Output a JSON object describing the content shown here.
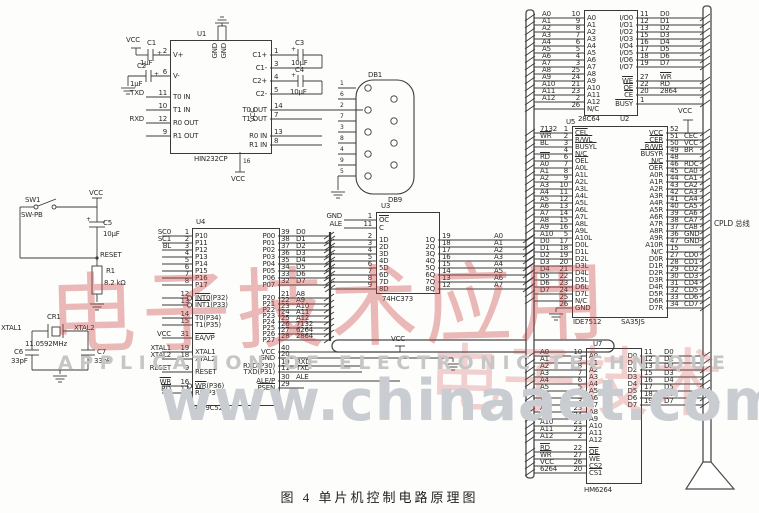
{
  "figure": {
    "caption": "图 4  单片机控制电路原理图"
  },
  "watermark": {
    "tagline": "APPLICATION OF ELECTRONIC TECHNIQUE",
    "url": "www.chinaaet.com",
    "stamp1": "电子技术应用",
    "stamp2": "电子技术"
  },
  "connector": {
    "ref": "DB1",
    "type": "DB9",
    "pins": [
      "1",
      "6",
      "2",
      "7",
      "3",
      "8",
      "4",
      "9",
      "5"
    ]
  },
  "annotations": {
    "vcc_c1": "VCC",
    "c1": "C1",
    "c1v": "1μF",
    "plus1": "+",
    "c2": "C2",
    "c2v": "1μF",
    "plus2": "+",
    "c3": "C3",
    "c3v": "10μF",
    "plus3": "+",
    "c4": "C4",
    "c4v": "10μF",
    "plus4": "+",
    "u1gnd1": "GND",
    "u1gnd2": "GND",
    "u1vccin": "VCC",
    "u1pin16": "16",
    "u1vccb": "VCC",
    "vcc_rst": "VCC",
    "sw_ref": "SW1",
    "sw_type": "SW-PB",
    "c5": "C5",
    "c5v": "10μF",
    "plus5": "+",
    "reset": "RESET",
    "r1": "R1",
    "r1v": "8.2 kΩ",
    "cr1": "CR1",
    "freq": "11.0592MHz",
    "xtal1": "XTAL1",
    "xtal2": "XTAL2",
    "c6": "C6",
    "c6v": "33pF",
    "c7": "C7",
    "c7v": "33pF",
    "vcc_u4": "VCC",
    "vcc_u5": "VCC",
    "cpld": "CPLD 总线"
  },
  "chips": [
    {
      "id": "u1",
      "ref": "U1",
      "part": "HIN232CP",
      "left": [
        {
          "o": "",
          "n": "2",
          "i": "V+"
        },
        {
          "o": "",
          "n": "6",
          "i": "V-"
        },
        {
          "o": "TXD",
          "n": "11",
          "i": "T0 IN"
        },
        {
          "o": "",
          "n": "10",
          "i": "T1 IN"
        },
        {
          "o": "RXD",
          "n": "12",
          "i": "R0 OUT"
        },
        {
          "o": "",
          "n": "9",
          "i": "R1 OUT"
        }
      ],
      "right": [
        {
          "i": "C1+",
          "n": "1",
          "o": ""
        },
        {
          "i": "C1-",
          "n": "3",
          "o": ""
        },
        {
          "i": "C2+",
          "n": "4",
          "o": ""
        },
        {
          "i": "C2-",
          "n": "5",
          "o": ""
        },
        {
          "i": "T0 OUT",
          "n": "14",
          "o": ""
        },
        {
          "i": "T1 OUT",
          "n": "7",
          "o": ""
        },
        {
          "i": "R0 IN",
          "n": "13",
          "o": ""
        },
        {
          "i": "R1 IN",
          "n": "8",
          "o": ""
        }
      ]
    },
    {
      "id": "u4",
      "ref": "U4",
      "part": "AT89C52",
      "left": [
        {
          "o": "SC0",
          "n": "1",
          "i": "P10"
        },
        {
          "o": "SC1",
          "n": "2",
          "i": "P11"
        },
        {
          "o": "BL",
          "n": "3",
          "i": "P12"
        },
        {
          "o": "",
          "n": "4",
          "i": "P13"
        },
        {
          "o": "",
          "n": "5",
          "i": "P14"
        },
        {
          "o": "",
          "n": "6",
          "i": "P15"
        },
        {
          "o": "",
          "n": "7",
          "i": "P16"
        },
        {
          "o": "",
          "n": "8",
          "i": "P17"
        },
        {
          "o": "",
          "n": "12",
          "i": "~INT0(P32)"
        },
        {
          "o": "",
          "n": "13",
          "i": "~INT1(P33)"
        },
        {
          "o": "",
          "n": "14",
          "i": "T0(P34)"
        },
        {
          "o": "",
          "n": "15",
          "i": "T1(P35)"
        },
        {
          "o": "VCC",
          "n": "31",
          "i": "~EA/VP"
        },
        {
          "o": "XTAL1",
          "n": "19",
          "i": "XTAL1"
        },
        {
          "o": "XTAL2",
          "n": "18",
          "i": "XTAL2"
        },
        {
          "o": "RESET",
          "n": "9",
          "i": "RESET"
        },
        {
          "o": "~WR",
          "n": "16",
          "i": "~WR(P36)"
        },
        {
          "o": "~RD",
          "n": "17",
          "i": "~RD(P37)"
        }
      ],
      "right": [
        {
          "i": "P00",
          "n": "39",
          "o": "D0"
        },
        {
          "i": "P01",
          "n": "38",
          "o": "D1"
        },
        {
          "i": "P02",
          "n": "37",
          "o": "D2"
        },
        {
          "i": "P03",
          "n": "36",
          "o": "D3"
        },
        {
          "i": "P04",
          "n": "35",
          "o": "D4"
        },
        {
          "i": "P05",
          "n": "34",
          "o": "D5"
        },
        {
          "i": "P06",
          "n": "33",
          "o": "D6"
        },
        {
          "i": "P07",
          "n": "32",
          "o": "D7"
        },
        {
          "i": "P20",
          "n": "21",
          "o": "A8"
        },
        {
          "i": "P21",
          "n": "22",
          "o": "A9"
        },
        {
          "i": "P22",
          "n": "23",
          "o": "A10"
        },
        {
          "i": "P23",
          "n": "24",
          "o": "A11"
        },
        {
          "i": "P24",
          "n": "25",
          "o": "A12"
        },
        {
          "i": "P25",
          "n": "26",
          "o": "7132"
        },
        {
          "i": "P26",
          "n": "27",
          "o": "6264"
        },
        {
          "i": "P27",
          "n": "28",
          "o": "2864"
        },
        {
          "i": "VCC",
          "n": "40",
          "o": ""
        },
        {
          "i": "GND",
          "n": "20",
          "o": ""
        },
        {
          "i": "RXD(P30)",
          "n": "10",
          "o": "RXD"
        },
        {
          "i": "TXD(P31)",
          "n": "11",
          "o": "TXD"
        },
        {
          "i": "ALE/P",
          "n": "30",
          "o": "ALE"
        },
        {
          "i": "~PSEN",
          "n": "29",
          "o": ""
        }
      ]
    },
    {
      "id": "u3",
      "ref": "U3",
      "part": "74HC373",
      "left": [
        {
          "o": "GND",
          "n": "1",
          "i": "~OC"
        },
        {
          "o": "ALE",
          "n": "11",
          "i": "C"
        },
        {
          "o": "",
          "n": "2",
          "i": "1D"
        },
        {
          "o": "",
          "n": "3",
          "i": "2D"
        },
        {
          "o": "",
          "n": "4",
          "i": "3D"
        },
        {
          "o": "",
          "n": "5",
          "i": "4D"
        },
        {
          "o": "",
          "n": "6",
          "i": "5D"
        },
        {
          "o": "",
          "n": "7",
          "i": "6D"
        },
        {
          "o": "",
          "n": "8",
          "i": "7D"
        },
        {
          "o": "",
          "n": "9",
          "i": "8D"
        }
      ],
      "right": [
        {
          "i": "1Q",
          "n": "19",
          "o": "A0"
        },
        {
          "i": "2Q",
          "n": "18",
          "o": "A1"
        },
        {
          "i": "3Q",
          "n": "17",
          "o": "A2"
        },
        {
          "i": "4Q",
          "n": "16",
          "o": "A3"
        },
        {
          "i": "5Q",
          "n": "15",
          "o": "A4"
        },
        {
          "i": "6Q",
          "n": "14",
          "o": "A5"
        },
        {
          "i": "7Q",
          "n": "13",
          "o": "A6"
        },
        {
          "i": "8Q",
          "n": "12",
          "o": "A7"
        }
      ]
    },
    {
      "id": "u2",
      "ref": "U2",
      "part": "28C64",
      "left": [
        {
          "o": "A0",
          "n": "10",
          "i": "A0"
        },
        {
          "o": "A1",
          "n": "9",
          "i": "A1"
        },
        {
          "o": "A2",
          "n": "8",
          "i": "A2"
        },
        {
          "o": "A3",
          "n": "7",
          "i": "A3"
        },
        {
          "o": "A4",
          "n": "6",
          "i": "A4"
        },
        {
          "o": "A5",
          "n": "5",
          "i": "A5"
        },
        {
          "o": "A6",
          "n": "4",
          "i": "A6"
        },
        {
          "o": "A7",
          "n": "3",
          "i": "A7"
        },
        {
          "o": "A8",
          "n": "25",
          "i": "A8"
        },
        {
          "o": "A9",
          "n": "24",
          "i": "A9"
        },
        {
          "o": "A10",
          "n": "21",
          "i": "A10"
        },
        {
          "o": "A11",
          "n": "23",
          "i": "A11"
        },
        {
          "o": "A12",
          "n": "2",
          "i": "A12"
        },
        {
          "o": "",
          "n": "26",
          "i": "N/C"
        }
      ],
      "right": [
        {
          "i": "I/O0",
          "n": "11",
          "o": "D0"
        },
        {
          "i": "I/O1",
          "n": "12",
          "o": "D1"
        },
        {
          "i": "I/O2",
          "n": "13",
          "o": "D2"
        },
        {
          "i": "I/O3",
          "n": "15",
          "o": "D3"
        },
        {
          "i": "I/O4",
          "n": "16",
          "o": "D4"
        },
        {
          "i": "I/O5",
          "n": "17",
          "o": "D5"
        },
        {
          "i": "I/O6",
          "n": "18",
          "o": "D6"
        },
        {
          "i": "I/O7",
          "n": "19",
          "o": "D7"
        },
        {
          "i": "~WE",
          "n": "27",
          "o": "~WR"
        },
        {
          "i": "~OE",
          "n": "22",
          "o": "RD"
        },
        {
          "i": "~CE",
          "n": "20",
          "o": "2864"
        },
        {
          "i": "~BUSY",
          "n": "1",
          "o": ""
        }
      ]
    },
    {
      "id": "u5",
      "ref": "U5",
      "part": "IDE7512",
      "part2": "SA35JS",
      "left": [
        {
          "o": "7132",
          "n": "1",
          "i": "~CEL"
        },
        {
          "o": "~WR",
          "n": "2",
          "i": "~R/WL"
        },
        {
          "o": "BL",
          "n": "3",
          "i": "~BUSYL"
        },
        {
          "o": "",
          "n": "4",
          "i": "N/C"
        },
        {
          "o": "~RD",
          "n": "6",
          "i": "~OEL"
        },
        {
          "o": "A0",
          "n": "7",
          "i": "A0L"
        },
        {
          "o": "A1",
          "n": "8",
          "i": "A1L"
        },
        {
          "o": "A2",
          "n": "9",
          "i": "A2L"
        },
        {
          "o": "A3",
          "n": "10",
          "i": "A3L"
        },
        {
          "o": "A4",
          "n": "11",
          "i": "A4L"
        },
        {
          "o": "A5",
          "n": "12",
          "i": "A5L"
        },
        {
          "o": "A6",
          "n": "13",
          "i": "A6L"
        },
        {
          "o": "A7",
          "n": "14",
          "i": "A7L"
        },
        {
          "o": "A8",
          "n": "15",
          "i": "A8L"
        },
        {
          "o": "A9",
          "n": "16",
          "i": "A9L"
        },
        {
          "o": "A10",
          "n": "5",
          "i": "A10L"
        },
        {
          "o": "D0",
          "n": "17",
          "i": "D0L"
        },
        {
          "o": "D1",
          "n": "18",
          "i": "D1L"
        },
        {
          "o": "D2",
          "n": "19",
          "i": "D2L"
        },
        {
          "o": "D3",
          "n": "20",
          "i": "D3L"
        },
        {
          "o": "D4",
          "n": "21",
          "i": "D4L"
        },
        {
          "o": "D5",
          "n": "22",
          "i": "D5L"
        },
        {
          "o": "D6",
          "n": "23",
          "i": "D6L"
        },
        {
          "o": "D7",
          "n": "24",
          "i": "D7L"
        },
        {
          "o": "",
          "n": "25",
          "i": "N/C"
        },
        {
          "o": "",
          "n": "26",
          "i": "GND"
        }
      ],
      "right": [
        {
          "i": "VCC",
          "n": "52",
          "o": ""
        },
        {
          "i": "~CER",
          "n": "51",
          "o": "CEC"
        },
        {
          "i": "~R/WR",
          "n": "50",
          "o": "VCC"
        },
        {
          "i": "~BUSYR",
          "n": "49",
          "o": "BR"
        },
        {
          "i": "N/C",
          "n": "48",
          "o": ""
        },
        {
          "i": "~OER",
          "n": "46",
          "o": "RDC"
        },
        {
          "i": "A0R",
          "n": "45",
          "o": "CA0"
        },
        {
          "i": "A1R",
          "n": "44",
          "o": "CA1"
        },
        {
          "i": "A2R",
          "n": "43",
          "o": "CA2"
        },
        {
          "i": "A3R",
          "n": "42",
          "o": "CA3"
        },
        {
          "i": "A4R",
          "n": "41",
          "o": "CA4"
        },
        {
          "i": "A5R",
          "n": "40",
          "o": "CA5"
        },
        {
          "i": "A6R",
          "n": "39",
          "o": "CA6"
        },
        {
          "i": "A7R",
          "n": "38",
          "o": "CA7"
        },
        {
          "i": "A8R",
          "n": "37",
          "o": "CA8"
        },
        {
          "i": "A9R",
          "n": "36",
          "o": "GND"
        },
        {
          "i": "A10R",
          "n": "47",
          "o": "GND"
        },
        {
          "i": "N/C",
          "n": "15",
          "o": ""
        },
        {
          "i": "D0R",
          "n": "27",
          "o": "CD0"
        },
        {
          "i": "D1R",
          "n": "28",
          "o": "CD1"
        },
        {
          "i": "D2R",
          "n": "29",
          "o": "CD2"
        },
        {
          "i": "D3R",
          "n": "30",
          "o": "CD3"
        },
        {
          "i": "D4R",
          "n": "31",
          "o": "CD4"
        },
        {
          "i": "D5R",
          "n": "32",
          "o": "CD5"
        },
        {
          "i": "D6R",
          "n": "33",
          "o": "CD6"
        },
        {
          "i": "D7R",
          "n": "34",
          "o": "CD7"
        }
      ]
    },
    {
      "id": "u7",
      "ref": "U7",
      "part": "HM6264",
      "left": [
        {
          "o": "A0",
          "n": "10",
          "i": "A0"
        },
        {
          "o": "A1",
          "n": "9",
          "i": "A1"
        },
        {
          "o": "A2",
          "n": "8",
          "i": "A2"
        },
        {
          "o": "A3",
          "n": "7",
          "i": "A3"
        },
        {
          "o": "A4",
          "n": "6",
          "i": "A4"
        },
        {
          "o": "A5",
          "n": "5",
          "i": "A5"
        },
        {
          "o": "A6",
          "n": "4",
          "i": "A6"
        },
        {
          "o": "A7",
          "n": "3",
          "i": "A7"
        },
        {
          "o": "A8",
          "n": "25",
          "i": "A8"
        },
        {
          "o": "A9",
          "n": "24",
          "i": "A9"
        },
        {
          "o": "A10",
          "n": "21",
          "i": "A10"
        },
        {
          "o": "A11",
          "n": "23",
          "i": "A11"
        },
        {
          "o": "A12",
          "n": "2",
          "i": "A12"
        },
        {
          "o": "~RD",
          "n": "22",
          "i": "~OE"
        },
        {
          "o": "~WR",
          "n": "27",
          "i": "~WE"
        },
        {
          "o": "VCC",
          "n": "26",
          "i": "CS2"
        },
        {
          "o": "6264",
          "n": "20",
          "i": "~CS1"
        }
      ],
      "right": [
        {
          "i": "D0",
          "n": "11",
          "o": "D0"
        },
        {
          "i": "D1",
          "n": "12",
          "o": "D1"
        },
        {
          "i": "D2",
          "n": "13",
          "o": "D2"
        },
        {
          "i": "D3",
          "n": "15",
          "o": "D3"
        },
        {
          "i": "D4",
          "n": "16",
          "o": "D4"
        },
        {
          "i": "D5",
          "n": "17",
          "o": "D5"
        },
        {
          "i": "D6",
          "n": "18",
          "o": "D6"
        },
        {
          "i": "D7",
          "n": "19",
          "o": "D7"
        }
      ]
    }
  ]
}
